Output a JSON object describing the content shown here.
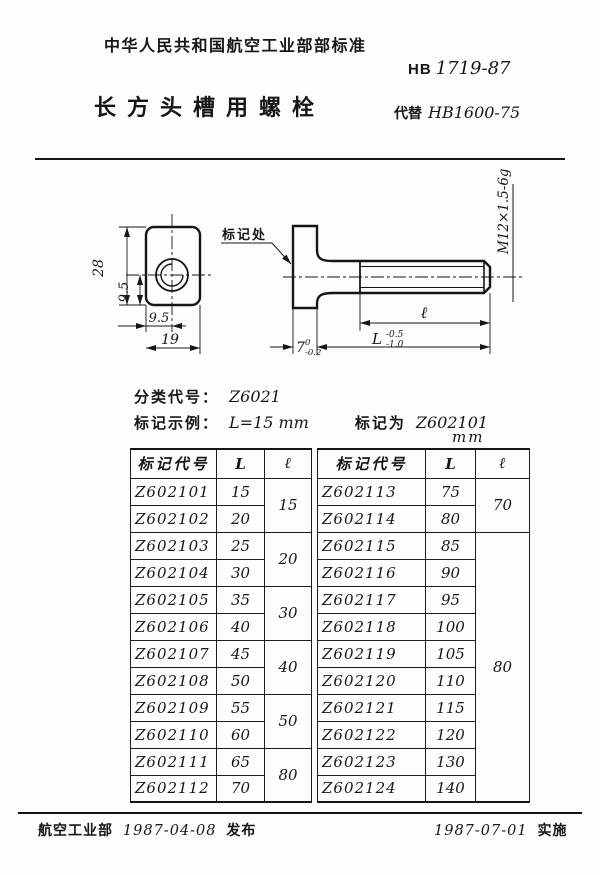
{
  "ink_color": "#161616",
  "paper_color": "#fdfdfb",
  "header": {
    "standard_org": "中华人民共和国航空工业部部标准",
    "standard_prefix": "HB",
    "standard_number": "1719-87",
    "title": "长方头槽用螺栓",
    "replaces_label": "代替",
    "replaces_number": "HB1600-75"
  },
  "drawing": {
    "mark_label": "标记处",
    "thread_callout": "M12×1.5-6g",
    "dims": {
      "head_height": "28",
      "hole_offset_vertical": "9.5",
      "hole_offset_horizontal": "9.5",
      "head_width": "19",
      "head_thickness": "7",
      "head_thickness_tol_upper": "0",
      "head_thickness_tol_lower": "-0.2",
      "thread_length_symbol": "ℓ",
      "overall_length_symbol": "L",
      "overall_length_tol_upper": "-0.5",
      "overall_length_tol_lower": "-1.0"
    }
  },
  "classification": {
    "class_label": "分类代号：",
    "class_code": "Z6021",
    "example_label": "标记示例：",
    "example_value": "L=15 mm",
    "mark_as_label": "标记为",
    "mark_as_code": "Z602101"
  },
  "table": {
    "units": "mm",
    "headers": {
      "code": "标记代号",
      "L": "L",
      "l": "ℓ"
    },
    "left": {
      "rows": [
        {
          "code": "Z602101",
          "L": "15"
        },
        {
          "code": "Z602102",
          "L": "20"
        },
        {
          "code": "Z602103",
          "L": "25"
        },
        {
          "code": "Z602104",
          "L": "30"
        },
        {
          "code": "Z602105",
          "L": "35"
        },
        {
          "code": "Z602106",
          "L": "40"
        },
        {
          "code": "Z602107",
          "L": "45"
        },
        {
          "code": "Z602108",
          "L": "50"
        },
        {
          "code": "Z602109",
          "L": "55"
        },
        {
          "code": "Z602110",
          "L": "60"
        },
        {
          "code": "Z602111",
          "L": "65"
        },
        {
          "code": "Z602112",
          "L": "70"
        }
      ],
      "l_groups": [
        "15",
        "20",
        "30",
        "40",
        "50",
        "80"
      ]
    },
    "right": {
      "rows": [
        {
          "code": "Z602113",
          "L": "75"
        },
        {
          "code": "Z602114",
          "L": "80"
        },
        {
          "code": "Z602115",
          "L": "85"
        },
        {
          "code": "Z602116",
          "L": "90"
        },
        {
          "code": "Z602117",
          "L": "95"
        },
        {
          "code": "Z602118",
          "L": "100"
        },
        {
          "code": "Z602119",
          "L": "105"
        },
        {
          "code": "Z602120",
          "L": "110"
        },
        {
          "code": "Z602121",
          "L": "115"
        },
        {
          "code": "Z602122",
          "L": "120"
        },
        {
          "code": "Z602123",
          "L": "130"
        },
        {
          "code": "Z602124",
          "L": "140"
        }
      ],
      "l_groups": [
        "70",
        "80"
      ]
    }
  },
  "footer": {
    "org": "航空工业部",
    "issue_date": "1987-04-08",
    "issue_label": "发布",
    "implement_date": "1987-07-01",
    "implement_label": "实施"
  }
}
